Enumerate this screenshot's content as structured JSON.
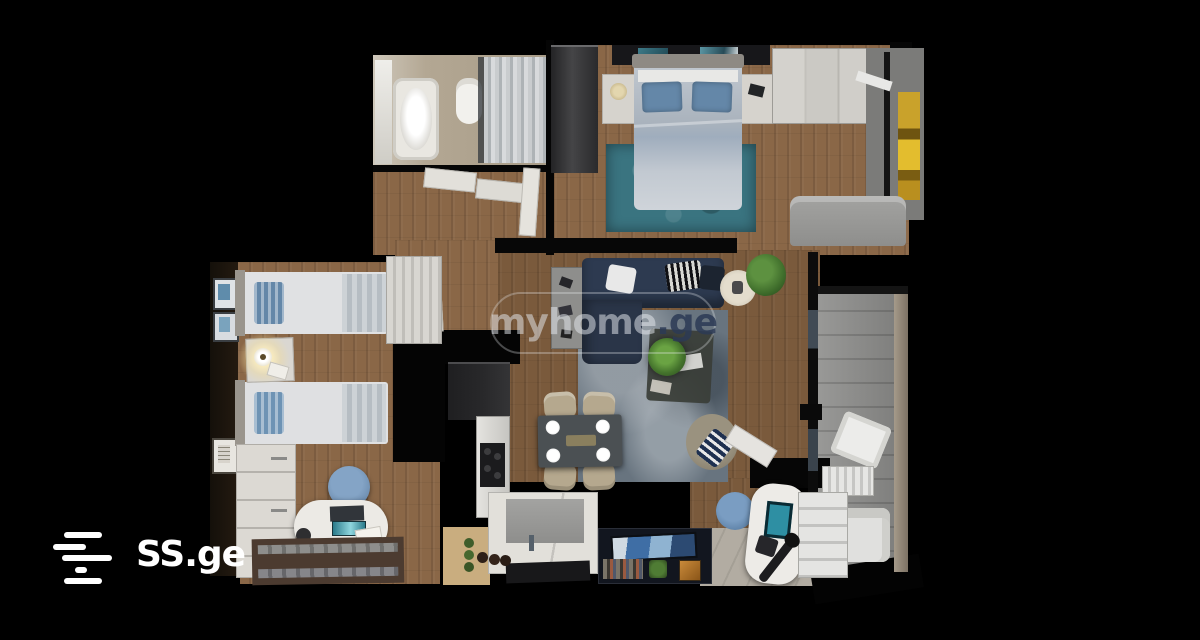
{
  "watermark": {
    "brand": "myhome",
    "domain": ".ge"
  },
  "logo": {
    "text": "SS.ge"
  },
  "colors": {
    "background": "#000000",
    "wood_floor": "#8a6747",
    "wood_floor_dark": "#7a5a3c",
    "bathroom_floor": "#b3a793",
    "bedroom_rug": "#3a7480",
    "living_rug": "#68747f",
    "sofa_navy": "#2d3a50",
    "bed_linen": "#c3cad2",
    "pillow_blue": "#6487a8",
    "balcony_floor": "#8d8d8b",
    "tile_floor": "#b2aca2",
    "kitchen_dark": "#28282a",
    "furniture_white": "#e2e0da",
    "chair_beige": "#b5a88e",
    "watermark_ge": "#2c3a55"
  }
}
